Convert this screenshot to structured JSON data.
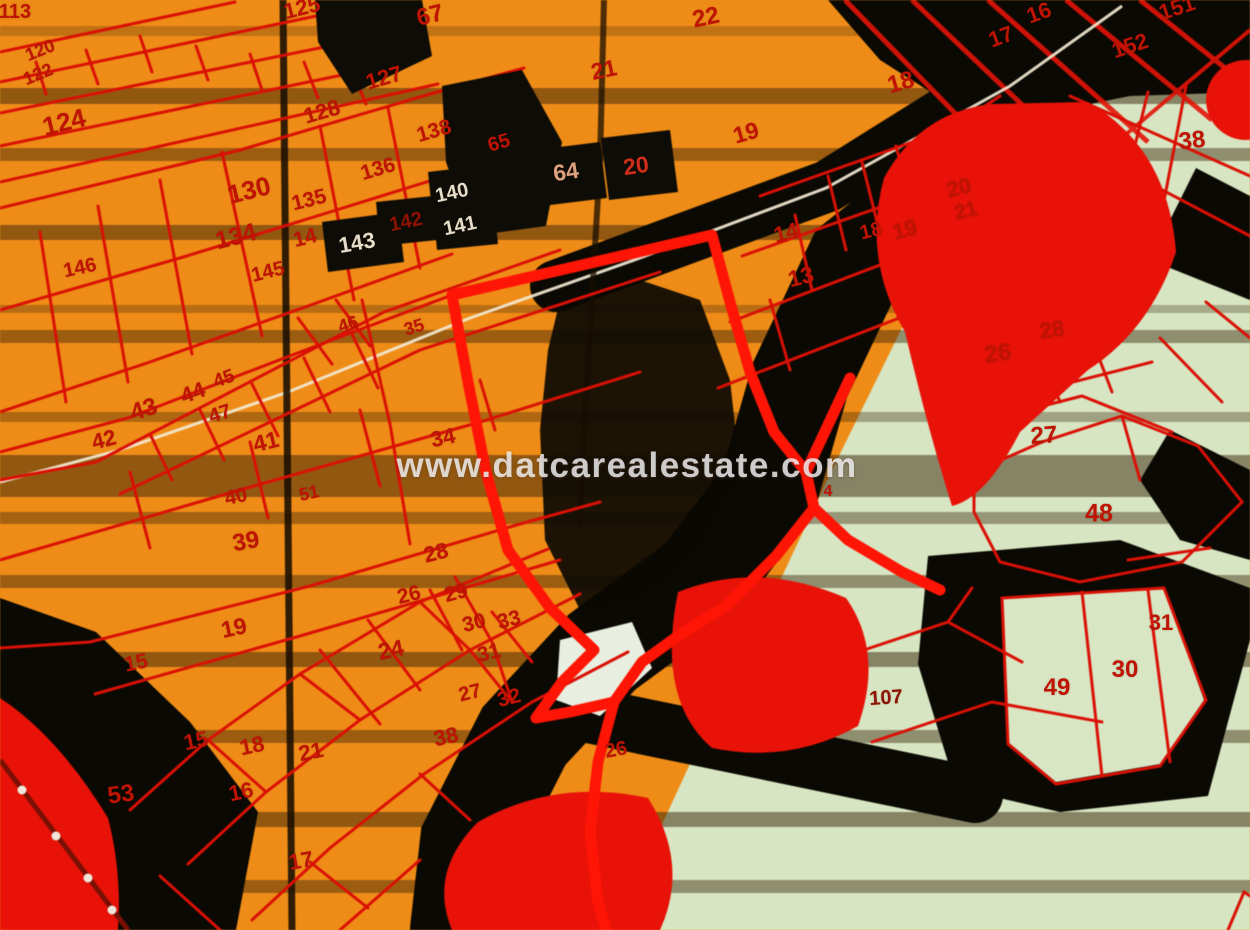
{
  "watermark": "www.datcarealestate.com",
  "map": {
    "type": "cadastral-parcel-map",
    "colors": {
      "red": "#bf1304",
      "dkred": "#8e1203",
      "white": "#e4ddca",
      "tan": "#dca07c",
      "red2": "#cf2f1a",
      "orange_zone": "#ef8c17",
      "green_zone": "#d7e5c2",
      "parcel_line_red": "#da1005",
      "road_black": "#0b0903",
      "highlight_red": "#ff1505"
    },
    "labels": [
      {
        "t": "113",
        "x": 15,
        "y": 12,
        "s": 20,
        "c": "red",
        "r": 0
      },
      {
        "t": "120",
        "x": 40,
        "y": 50,
        "s": 18,
        "c": "red",
        "r": -22
      },
      {
        "t": "122",
        "x": 38,
        "y": 74,
        "s": 18,
        "c": "red",
        "r": -22
      },
      {
        "t": "124",
        "x": 64,
        "y": 122,
        "s": 26,
        "c": "red",
        "r": -14
      },
      {
        "t": "146",
        "x": 80,
        "y": 268,
        "s": 20,
        "c": "red",
        "r": -12
      },
      {
        "t": "125",
        "x": 302,
        "y": 8,
        "s": 22,
        "c": "red",
        "r": -14
      },
      {
        "t": "67",
        "x": 430,
        "y": 16,
        "s": 24,
        "c": "red",
        "r": -14
      },
      {
        "t": "127",
        "x": 384,
        "y": 78,
        "s": 22,
        "c": "red",
        "r": -16
      },
      {
        "t": "128",
        "x": 322,
        "y": 112,
        "s": 22,
        "c": "red",
        "r": -16
      },
      {
        "t": "138",
        "x": 434,
        "y": 131,
        "s": 21,
        "c": "red",
        "r": -16
      },
      {
        "t": "136",
        "x": 378,
        "y": 169,
        "s": 21,
        "c": "red",
        "r": -16
      },
      {
        "t": "65",
        "x": 499,
        "y": 143,
        "s": 20,
        "c": "red",
        "r": -16
      },
      {
        "t": "130",
        "x": 249,
        "y": 190,
        "s": 26,
        "c": "red",
        "r": -14
      },
      {
        "t": "135",
        "x": 309,
        "y": 200,
        "s": 21,
        "c": "red",
        "r": -14
      },
      {
        "t": "140",
        "x": 452,
        "y": 193,
        "s": 20,
        "c": "white",
        "r": -12
      },
      {
        "t": "142",
        "x": 406,
        "y": 222,
        "s": 20,
        "c": "dkred",
        "r": -12
      },
      {
        "t": "141",
        "x": 460,
        "y": 226,
        "s": 20,
        "c": "white",
        "r": -12
      },
      {
        "t": "134",
        "x": 236,
        "y": 237,
        "s": 25,
        "c": "red",
        "r": -14
      },
      {
        "t": "14",
        "x": 305,
        "y": 238,
        "s": 21,
        "c": "red",
        "r": -14
      },
      {
        "t": "143",
        "x": 357,
        "y": 243,
        "s": 22,
        "c": "white",
        "r": -10
      },
      {
        "t": "145",
        "x": 268,
        "y": 272,
        "s": 20,
        "c": "red",
        "r": -14
      },
      {
        "t": "64",
        "x": 566,
        "y": 172,
        "s": 23,
        "c": "tan",
        "r": -8
      },
      {
        "t": "20",
        "x": 636,
        "y": 166,
        "s": 23,
        "c": "red2",
        "r": -8
      },
      {
        "t": "21",
        "x": 604,
        "y": 70,
        "s": 23,
        "c": "red",
        "r": -12
      },
      {
        "t": "22",
        "x": 706,
        "y": 18,
        "s": 24,
        "c": "red",
        "r": -12
      },
      {
        "t": "19",
        "x": 746,
        "y": 133,
        "s": 23,
        "c": "red",
        "r": -16
      },
      {
        "t": "18",
        "x": 901,
        "y": 83,
        "s": 24,
        "c": "red",
        "r": -16
      },
      {
        "t": "17",
        "x": 1001,
        "y": 37,
        "s": 22,
        "c": "red",
        "r": -20
      },
      {
        "t": "16",
        "x": 1039,
        "y": 13,
        "s": 22,
        "c": "red",
        "r": -20
      },
      {
        "t": "151",
        "x": 1177,
        "y": 8,
        "s": 22,
        "c": "red",
        "r": -18
      },
      {
        "t": "152",
        "x": 1130,
        "y": 46,
        "s": 22,
        "c": "red",
        "r": -18
      },
      {
        "t": "38",
        "x": 1192,
        "y": 141,
        "s": 24,
        "c": "red",
        "r": -6
      },
      {
        "t": "20",
        "x": 959,
        "y": 188,
        "s": 22,
        "c": "red",
        "r": -14
      },
      {
        "t": "21",
        "x": 966,
        "y": 211,
        "s": 20,
        "c": "red",
        "r": -14
      },
      {
        "t": "14",
        "x": 786,
        "y": 233,
        "s": 22,
        "c": "red",
        "r": -14
      },
      {
        "t": "18",
        "x": 871,
        "y": 231,
        "s": 20,
        "c": "red",
        "r": -14
      },
      {
        "t": "19",
        "x": 905,
        "y": 230,
        "s": 22,
        "c": "red",
        "r": -14
      },
      {
        "t": "13",
        "x": 801,
        "y": 277,
        "s": 23,
        "c": "red",
        "r": -14
      },
      {
        "t": "26",
        "x": 998,
        "y": 354,
        "s": 24,
        "c": "red",
        "r": -8
      },
      {
        "t": "28",
        "x": 1052,
        "y": 330,
        "s": 22,
        "c": "red",
        "r": -8
      },
      {
        "t": "27",
        "x": 1044,
        "y": 436,
        "s": 24,
        "c": "red",
        "r": -4
      },
      {
        "t": "48",
        "x": 1099,
        "y": 514,
        "s": 25,
        "c": "red",
        "r": 0
      },
      {
        "t": "31",
        "x": 1161,
        "y": 623,
        "s": 22,
        "c": "red",
        "r": 0
      },
      {
        "t": "30",
        "x": 1125,
        "y": 670,
        "s": 24,
        "c": "red",
        "r": 0
      },
      {
        "t": "49",
        "x": 1057,
        "y": 688,
        "s": 24,
        "c": "red",
        "r": 0
      },
      {
        "t": "107",
        "x": 886,
        "y": 698,
        "s": 20,
        "c": "dkred",
        "r": -4
      },
      {
        "t": "4",
        "x": 828,
        "y": 492,
        "s": 16,
        "c": "red",
        "r": 0
      },
      {
        "t": "46",
        "x": 348,
        "y": 324,
        "s": 18,
        "c": "red",
        "r": -18
      },
      {
        "t": "35",
        "x": 414,
        "y": 327,
        "s": 18,
        "c": "red",
        "r": -18
      },
      {
        "t": "44",
        "x": 193,
        "y": 393,
        "s": 22,
        "c": "red",
        "r": -20
      },
      {
        "t": "43",
        "x": 144,
        "y": 410,
        "s": 24,
        "c": "red",
        "r": -18
      },
      {
        "t": "45",
        "x": 224,
        "y": 379,
        "s": 19,
        "c": "red",
        "r": -20
      },
      {
        "t": "47",
        "x": 220,
        "y": 414,
        "s": 20,
        "c": "red",
        "r": -18
      },
      {
        "t": "41",
        "x": 266,
        "y": 442,
        "s": 23,
        "c": "red",
        "r": -14
      },
      {
        "t": "42",
        "x": 104,
        "y": 440,
        "s": 22,
        "c": "red",
        "r": -14
      },
      {
        "t": "40",
        "x": 236,
        "y": 497,
        "s": 20,
        "c": "red",
        "r": -12
      },
      {
        "t": "51",
        "x": 309,
        "y": 493,
        "s": 18,
        "c": "red",
        "r": -12
      },
      {
        "t": "34",
        "x": 443,
        "y": 438,
        "s": 22,
        "c": "red",
        "r": -12
      },
      {
        "t": "39",
        "x": 246,
        "y": 542,
        "s": 24,
        "c": "red",
        "r": -10
      },
      {
        "t": "19",
        "x": 234,
        "y": 628,
        "s": 23,
        "c": "red",
        "r": -12
      },
      {
        "t": "15",
        "x": 136,
        "y": 663,
        "s": 21,
        "c": "red",
        "r": -12
      },
      {
        "t": "24",
        "x": 391,
        "y": 650,
        "s": 23,
        "c": "red",
        "r": -12
      },
      {
        "t": "28",
        "x": 436,
        "y": 553,
        "s": 22,
        "c": "red",
        "r": -14
      },
      {
        "t": "26",
        "x": 409,
        "y": 595,
        "s": 21,
        "c": "red",
        "r": -14
      },
      {
        "t": "29",
        "x": 456,
        "y": 593,
        "s": 21,
        "c": "red",
        "r": -14
      },
      {
        "t": "30",
        "x": 474,
        "y": 623,
        "s": 21,
        "c": "red",
        "r": -14
      },
      {
        "t": "33",
        "x": 509,
        "y": 620,
        "s": 21,
        "c": "red",
        "r": -14
      },
      {
        "t": "31",
        "x": 489,
        "y": 653,
        "s": 21,
        "c": "red",
        "r": -14
      },
      {
        "t": "32",
        "x": 509,
        "y": 698,
        "s": 21,
        "c": "red",
        "r": -14
      },
      {
        "t": "27",
        "x": 470,
        "y": 693,
        "s": 20,
        "c": "red",
        "r": -14
      },
      {
        "t": "38",
        "x": 446,
        "y": 737,
        "s": 22,
        "c": "red",
        "r": -12
      },
      {
        "t": "15",
        "x": 196,
        "y": 741,
        "s": 22,
        "c": "red",
        "r": -12
      },
      {
        "t": "18",
        "x": 252,
        "y": 746,
        "s": 22,
        "c": "red",
        "r": -12
      },
      {
        "t": "21",
        "x": 311,
        "y": 752,
        "s": 22,
        "c": "red",
        "r": -12
      },
      {
        "t": "16",
        "x": 241,
        "y": 792,
        "s": 22,
        "c": "red",
        "r": -12
      },
      {
        "t": "53",
        "x": 121,
        "y": 795,
        "s": 24,
        "c": "red",
        "r": -8
      },
      {
        "t": "17",
        "x": 301,
        "y": 861,
        "s": 22,
        "c": "red",
        "r": -10
      },
      {
        "t": "26",
        "x": 616,
        "y": 750,
        "s": 20,
        "c": "red",
        "r": -10
      }
    ]
  }
}
